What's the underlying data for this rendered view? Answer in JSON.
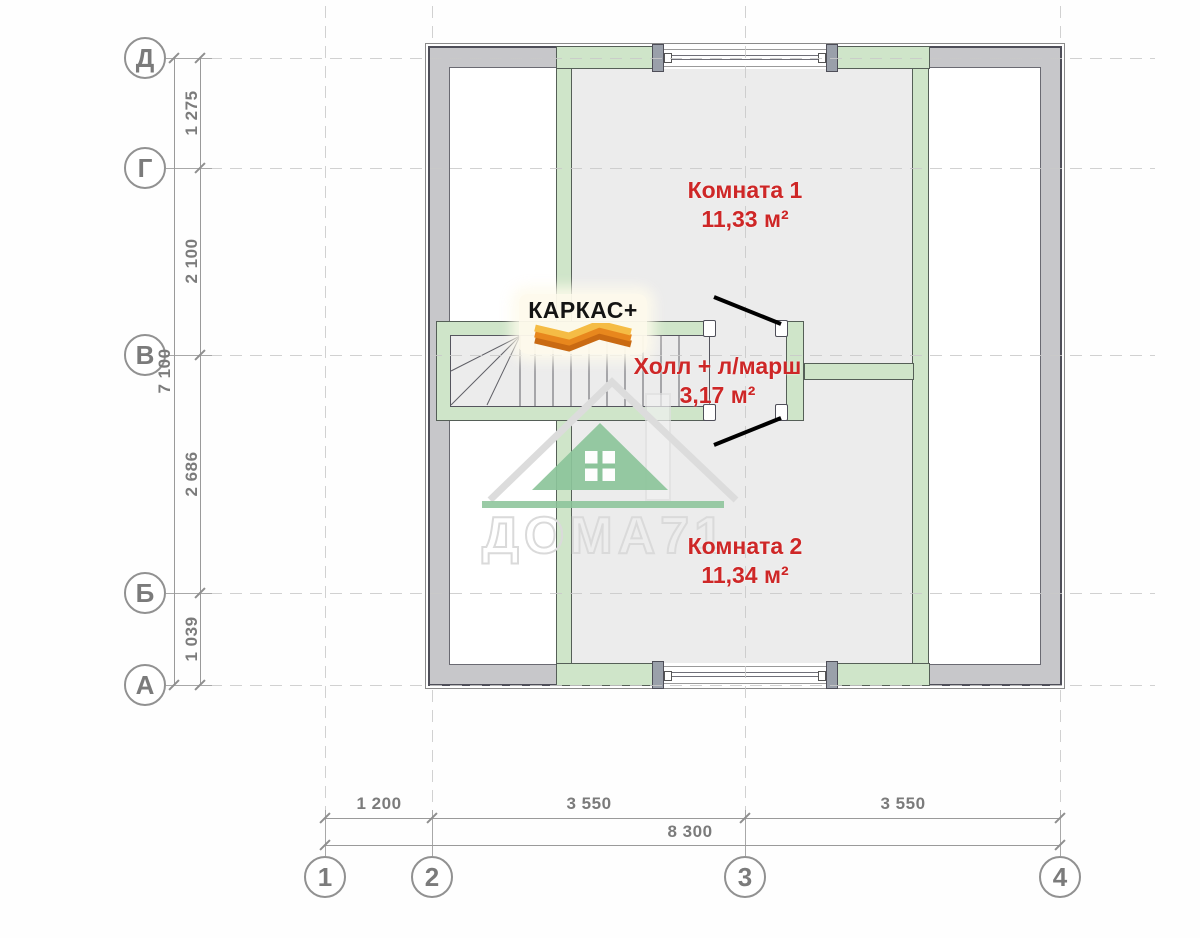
{
  "drawing": {
    "type": "floor-plan",
    "rooms": [
      {
        "name": "Комната 1",
        "area": "11,33 м²"
      },
      {
        "name": "Холл + л/марш",
        "area": "3,17 м²"
      },
      {
        "name": "Комната 2",
        "area": "11,34 м²"
      }
    ]
  },
  "axes": {
    "rows": [
      "Д",
      "Г",
      "В",
      "Б",
      "А"
    ],
    "cols": [
      "1",
      "2",
      "3",
      "4"
    ]
  },
  "dimensions": {
    "left_segments": [
      "1 275",
      "2 100",
      "2 686",
      "1 039"
    ],
    "left_total": "7 100",
    "bottom_segments": [
      "1 200",
      "3 550",
      "3 550"
    ],
    "bottom_total": "8 300"
  },
  "branding": {
    "logo_text": "КАРКАС+",
    "watermark_text": "ДОМА71"
  },
  "colors": {
    "label_red": "#ce2727",
    "wall_green": "#cfe5c9",
    "wall_gray": "#c7c7ca",
    "wall_border": "#4e4e58",
    "watermark_green": "#8cc49a",
    "dimension_gray": "#7b7b7b"
  }
}
